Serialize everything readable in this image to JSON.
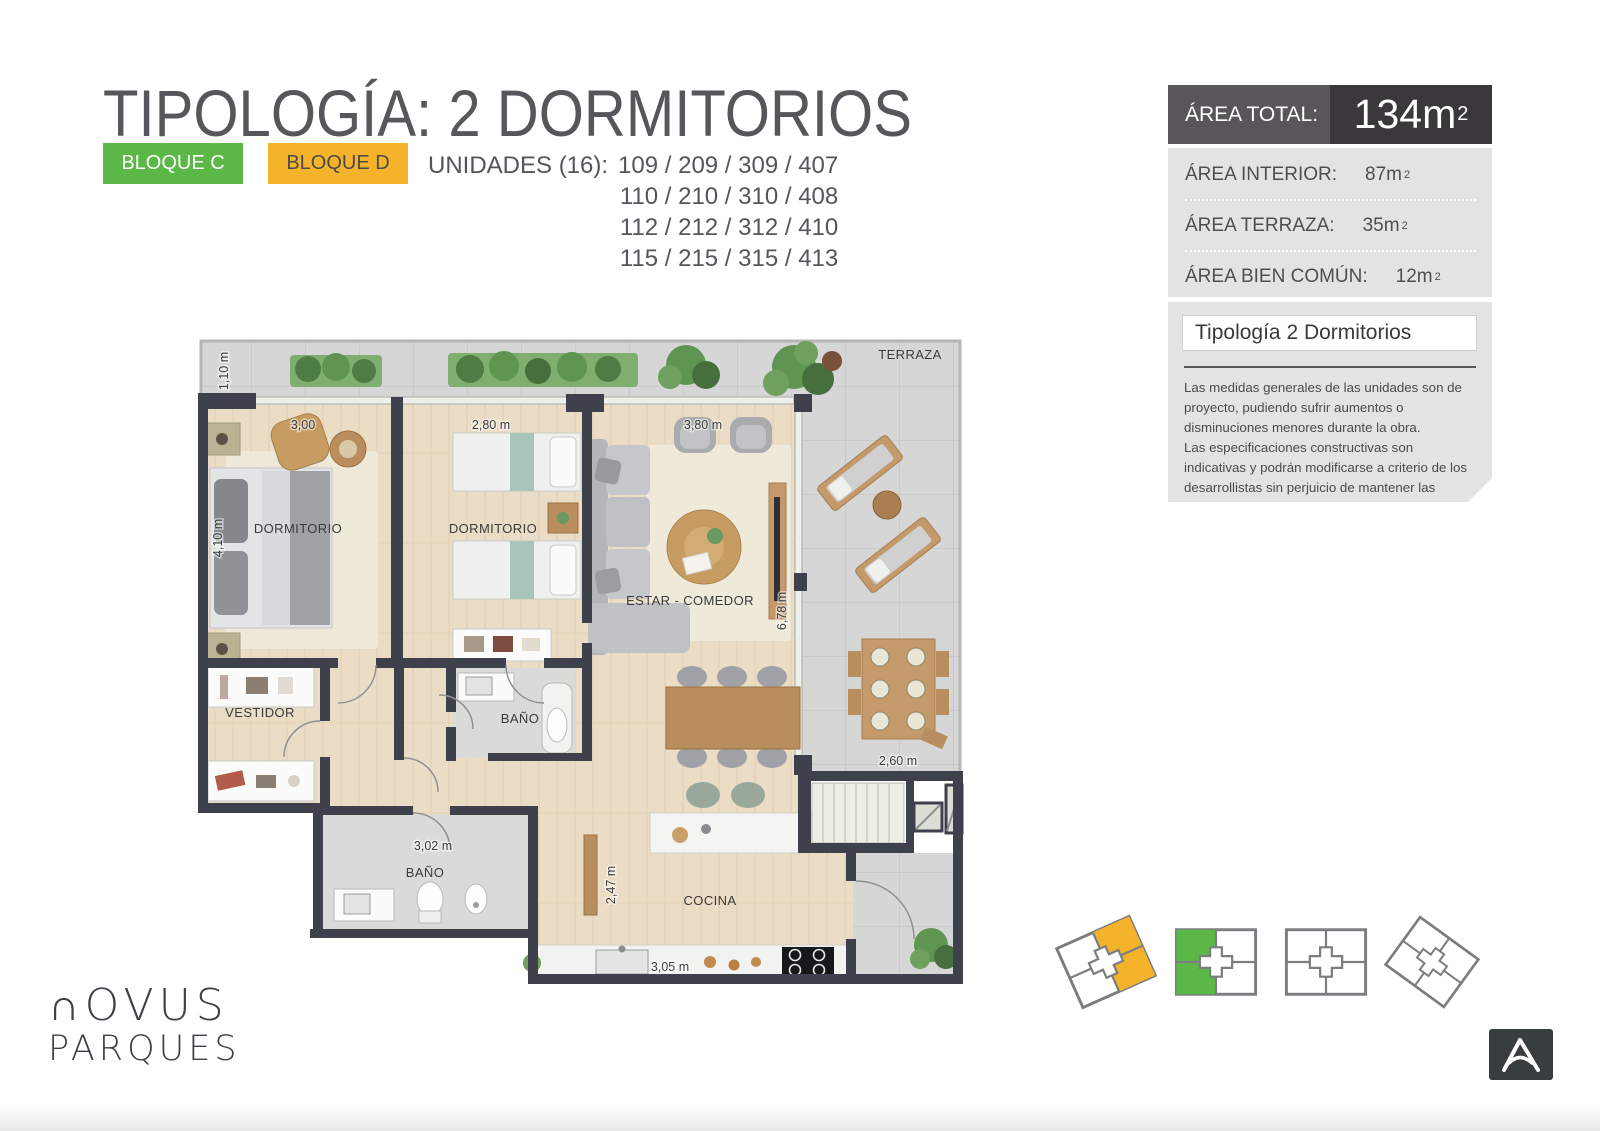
{
  "header": {
    "title": "TIPOLOGÍA: 2 DORMITORIOS",
    "badge_c": "BLOQUE C",
    "badge_d": "BLOQUE D",
    "units_label": "UNIDADES (16):",
    "units_lines": [
      "109 / 209 / 309 / 407",
      "110 / 210 / 310 / 408",
      "112 / 212 / 312 / 410",
      "115 / 215 / 315 / 413"
    ]
  },
  "area_panel": {
    "total_label": "ÁREA TOTAL:",
    "total_value": "134m",
    "total_sup": "2",
    "rows": [
      {
        "label": "ÁREA INTERIOR:",
        "value": "87m",
        "sup": "2"
      },
      {
        "label": "ÁREA TERRAZA:",
        "value": "35m",
        "sup": "2"
      },
      {
        "label": "ÁREA BIEN COMÚN:",
        "value": "12m",
        "sup": "2"
      }
    ]
  },
  "info_panel": {
    "title": "Tipología 2 Dormitorios",
    "paragraphs": [
      "Las medidas generales de las unidades son de proyecto, pudiendo sufrir aumentos o disminuciones menores durante la obra.",
      "Las especificaciones constructivas son indicativas y podrán modificarse a criterio de los desarrollistas sin perjuicio de mantener las calidades generales."
    ]
  },
  "floorplan": {
    "rooms": {
      "master_bedroom": "DORMITORIO",
      "bedroom2": "DORMITORIO",
      "living": "ESTAR - COMEDOR",
      "terrace": "TERRAZA",
      "dressing": "VESTIDOR",
      "bath_upper": "BAÑO",
      "bath_main": "BAÑO",
      "kitchen": "COCINA"
    },
    "dimensions": {
      "terrace_depth": "1,10 m",
      "master_width": "3,00",
      "bedroom2_width": "2,80 m",
      "living_width": "3,80 m",
      "master_height": "4,10 m",
      "living_height": "6,78 m",
      "bath_width": "3,02 m",
      "kitchen_height": "2,47 m",
      "kitchen_width": "3,05 m",
      "stair_width": "2,60 m"
    }
  },
  "brand": {
    "line1": "∩OVUS",
    "line2": "PARQUES"
  },
  "colors": {
    "badge_green": "#5bb847",
    "badge_orange": "#f5b32b",
    "bar_gray": "#595659",
    "bar_dark": "#3a383b",
    "panel_gray": "#e3e3e4",
    "wall": "#3e414b"
  }
}
